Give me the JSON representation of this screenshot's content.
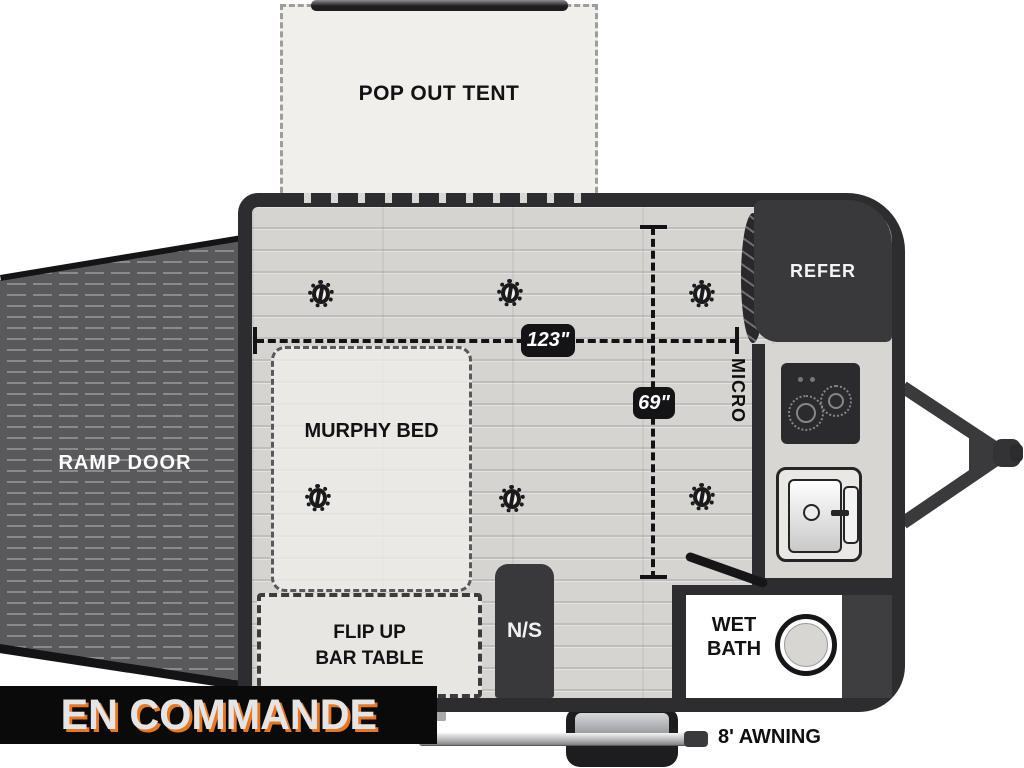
{
  "banner": {
    "text": "EN COMMANDE",
    "text_color": "#e4e5e7",
    "accent_color": "#e87722",
    "bg_color": "#0a0a0a"
  },
  "floorplan": {
    "pop_out_tent": "POP OUT TENT",
    "ramp_door": "RAMP DOOR",
    "murphy_bed": "MURPHY BED",
    "flip_up_bar_table": {
      "line1": "FLIP UP",
      "line2": "BAR TABLE"
    },
    "nightstand": "N/S",
    "refrigerator": "REFER",
    "microwave": "MICRO",
    "wet_bath": {
      "line1": "WET",
      "line2": "BATH"
    },
    "awning": "8' AWNING",
    "dimensions": {
      "length": "123\"",
      "width": "69\""
    }
  }
}
